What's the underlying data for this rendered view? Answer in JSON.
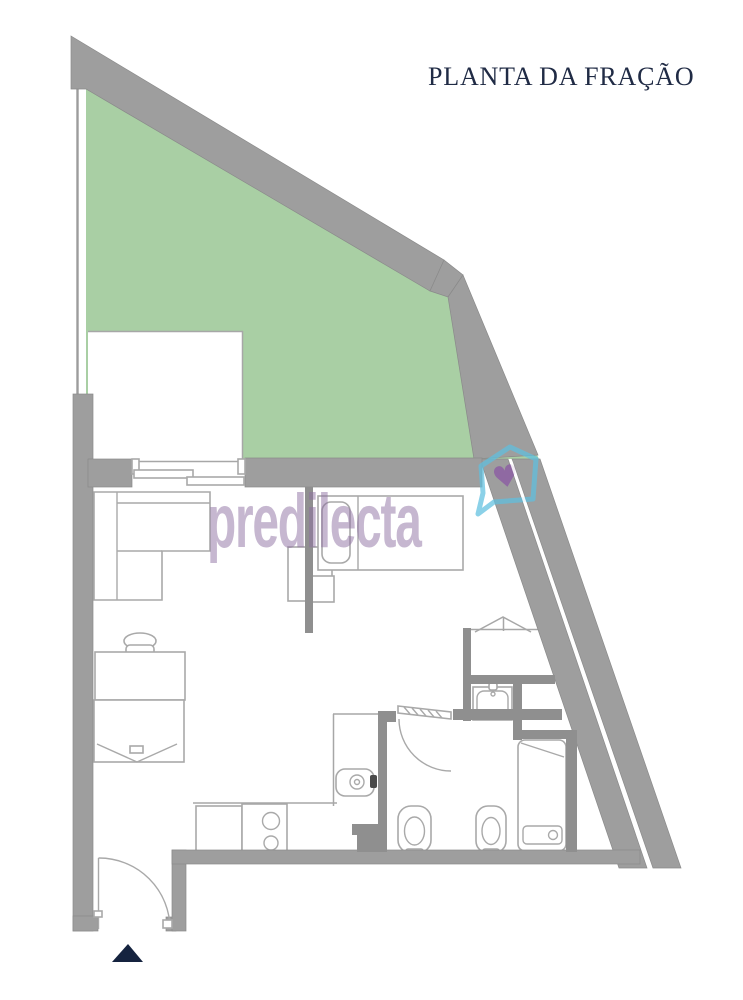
{
  "header": {
    "title": "PLANTA DA FRAÇÃO"
  },
  "watermark": {
    "text": "predilecta",
    "logo": "house-heart-icon",
    "heart_glyph": "♥"
  },
  "plan": {
    "type": "apartment-unit-floor-plan",
    "highlighted_area": "terrace-green-zone",
    "north_marker": "up-triangle"
  },
  "theme": {
    "background": "#ffffff",
    "wall": "#9e9e9e",
    "wallEdge": "#8a8a8a",
    "interiorWall": "#8f8f8f",
    "terrace": "#a9cfa4",
    "line": "#a7a7a7",
    "furniture": "#a9a9a9",
    "fixtureDark": "#4a4a4a",
    "titleColor": "#202b45",
    "watermarkColor": "rgba(141,111,162,0.5)",
    "logoBlue": "#5fc0e0",
    "heartPurple": "#8a56a4",
    "northMarker": "#15233f"
  }
}
